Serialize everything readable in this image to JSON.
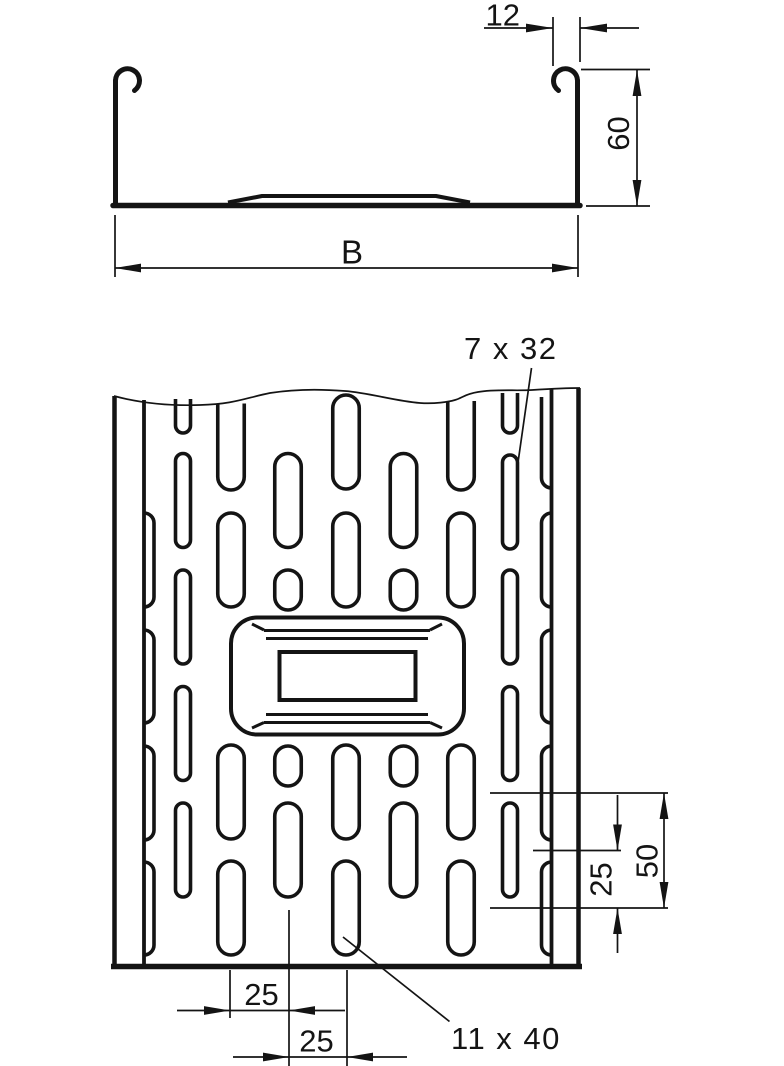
{
  "drawing": {
    "type": "technical-drawing-cable-tray",
    "labels": {
      "flange_width": "12",
      "side_height": "60",
      "tray_width": "B",
      "side_slot_size": "7 x 32",
      "bottom_slot_size": "11 x 40",
      "slot_pitch": "50",
      "slot_spacing": "25",
      "hole_offset_1": "25",
      "hole_offset_2": "25"
    },
    "colors": {
      "line": "#141414",
      "background": "#ffffff"
    }
  }
}
